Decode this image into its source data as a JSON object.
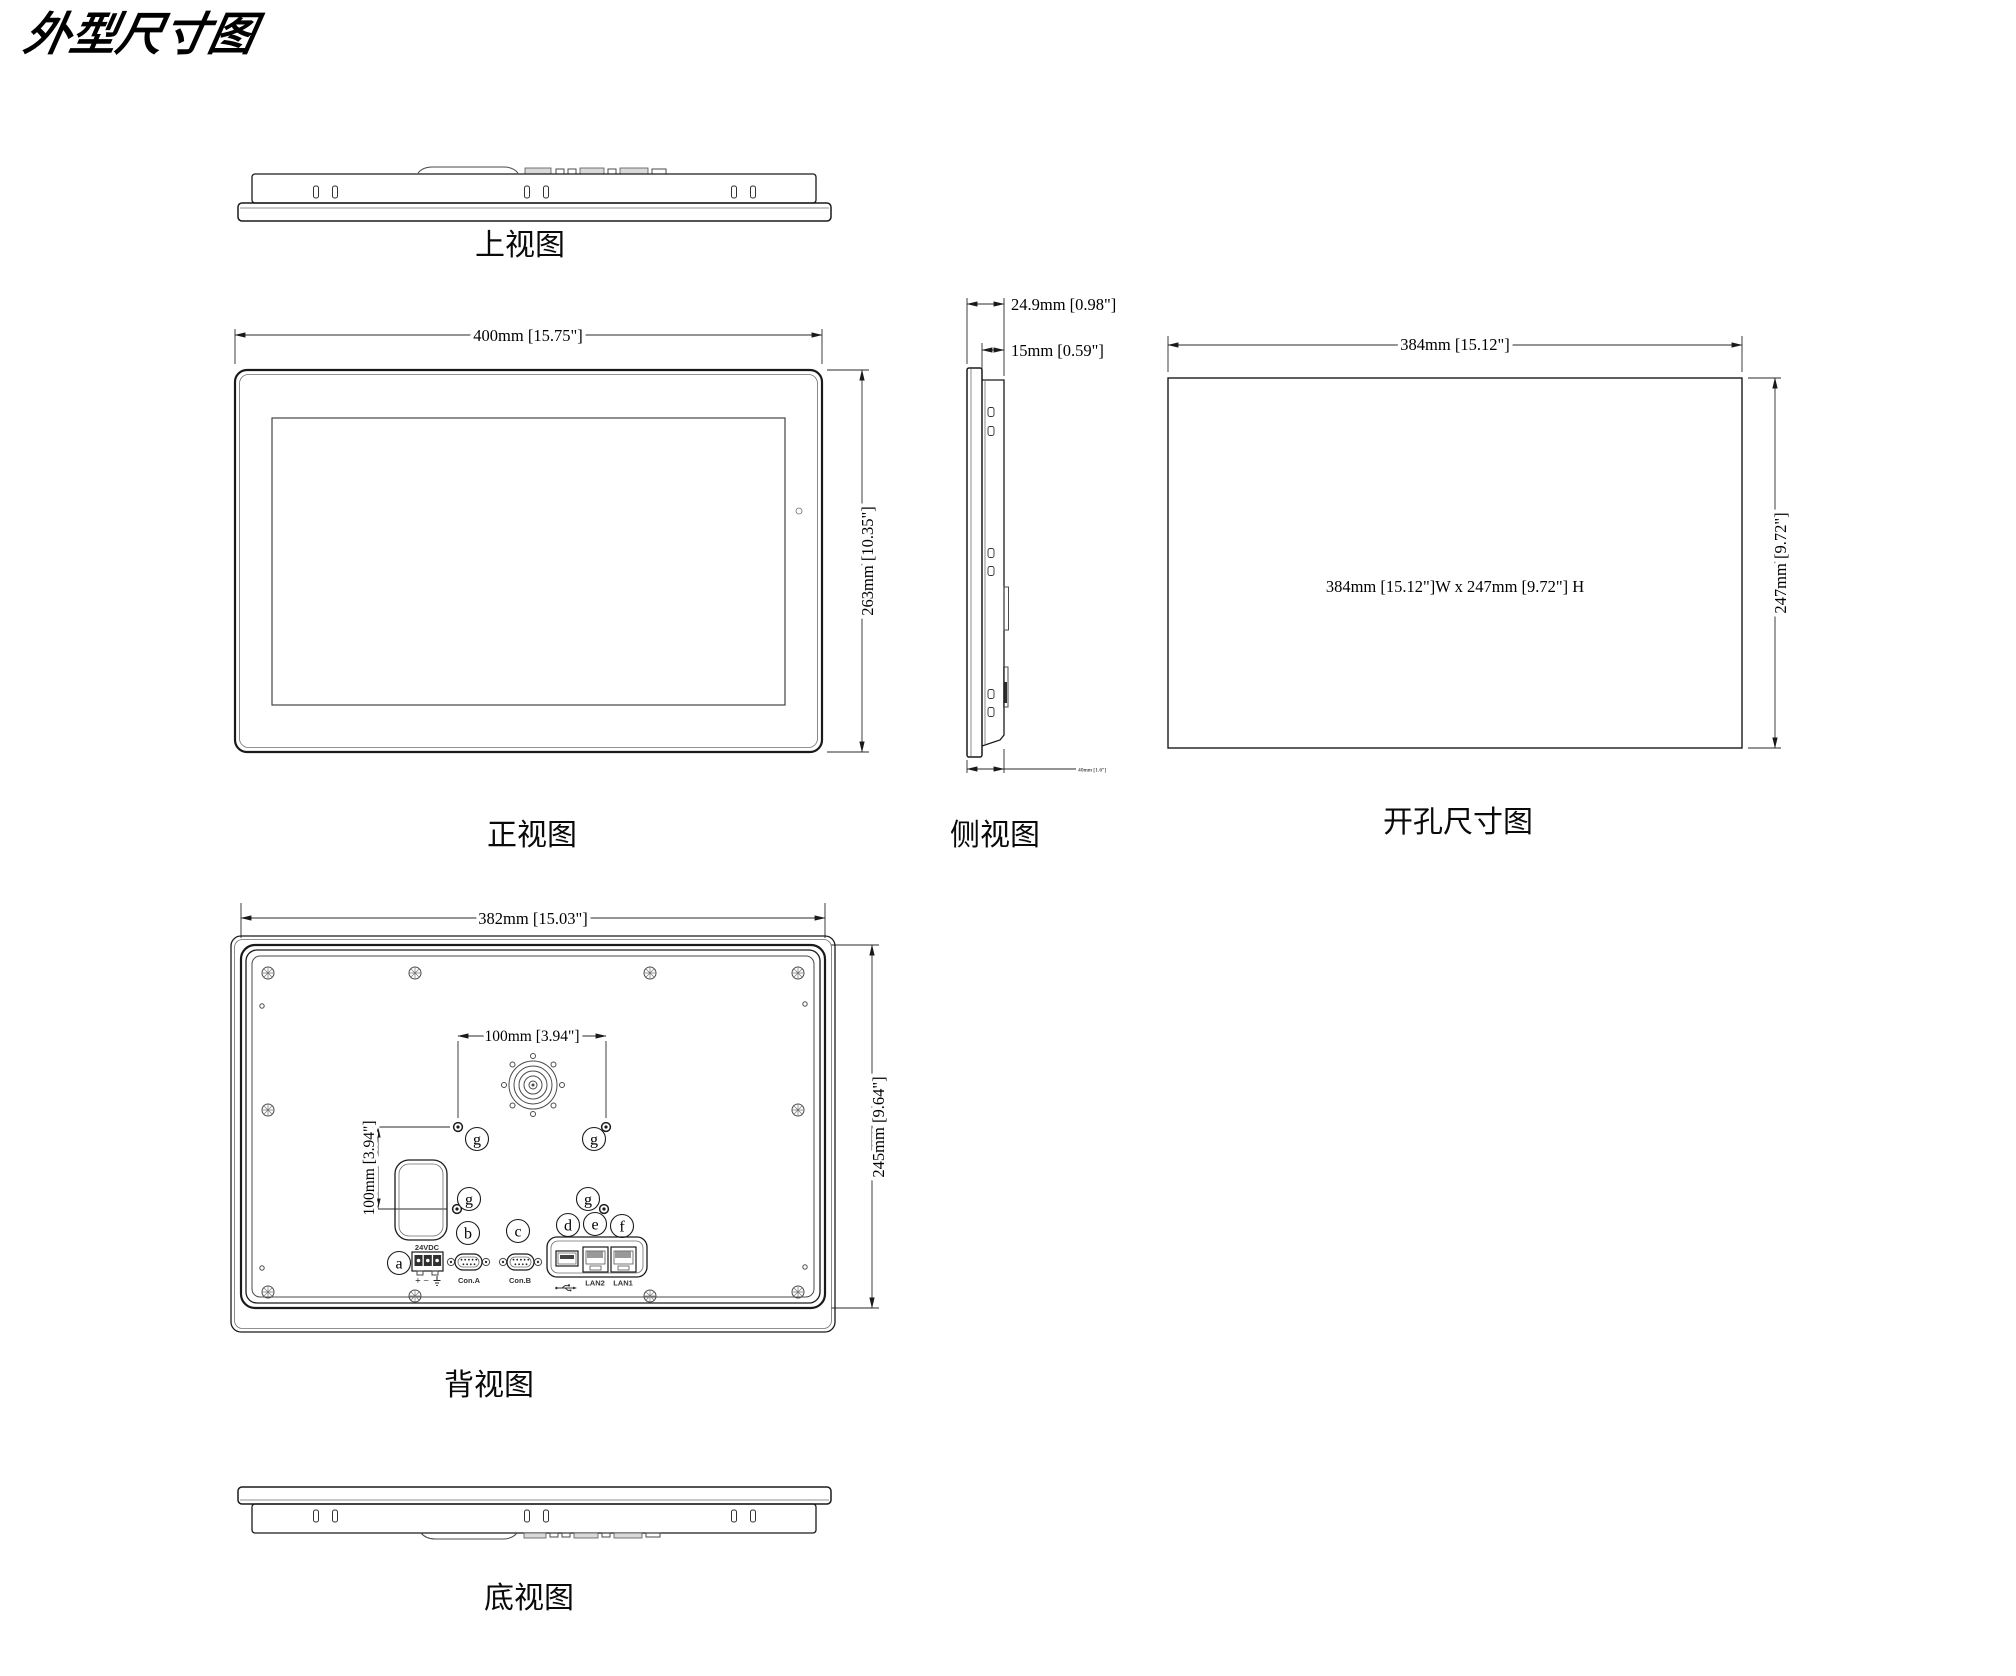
{
  "title": "外型尺寸图",
  "views": {
    "top": {
      "label": "上视图"
    },
    "front": {
      "label": "正视图",
      "width_dim": "400mm [15.75\"]",
      "height_dim": "263mm [10.35\"]"
    },
    "side": {
      "label": "侧视图",
      "depth_dim": "24.9mm [0.98\"]",
      "bezel_dim": "15mm [0.59\"]",
      "mount_dim": "40mm [1.6\"]"
    },
    "cutout": {
      "label": "开孔尺寸图",
      "width_dim": "384mm [15.12\"]",
      "height_dim": "247mm [9.72\"]",
      "note": "384mm [15.12\"]W x 247mm [9.72\"] H"
    },
    "back": {
      "label": "背视图",
      "width_dim": "382mm [15.03\"]",
      "height_dim": "245mm [9.64\"]",
      "vesa_h_dim": "100mm [3.94\"]",
      "vesa_v_dim": "100mm [3.94\"]",
      "power_label": "24VDC",
      "polarity": "+ −",
      "con_a": "Con.A",
      "con_b": "Con.B",
      "lan2": "LAN2",
      "lan1": "LAN1",
      "callouts": {
        "a": "a",
        "b": "b",
        "c": "c",
        "d": "d",
        "e": "e",
        "f": "f",
        "g": "g"
      }
    },
    "bottom": {
      "label": "底视图"
    }
  },
  "colors": {
    "line": "#1a1a1a",
    "line_light": "#6e6e6e",
    "text": "#000000",
    "background": "#ffffff"
  }
}
